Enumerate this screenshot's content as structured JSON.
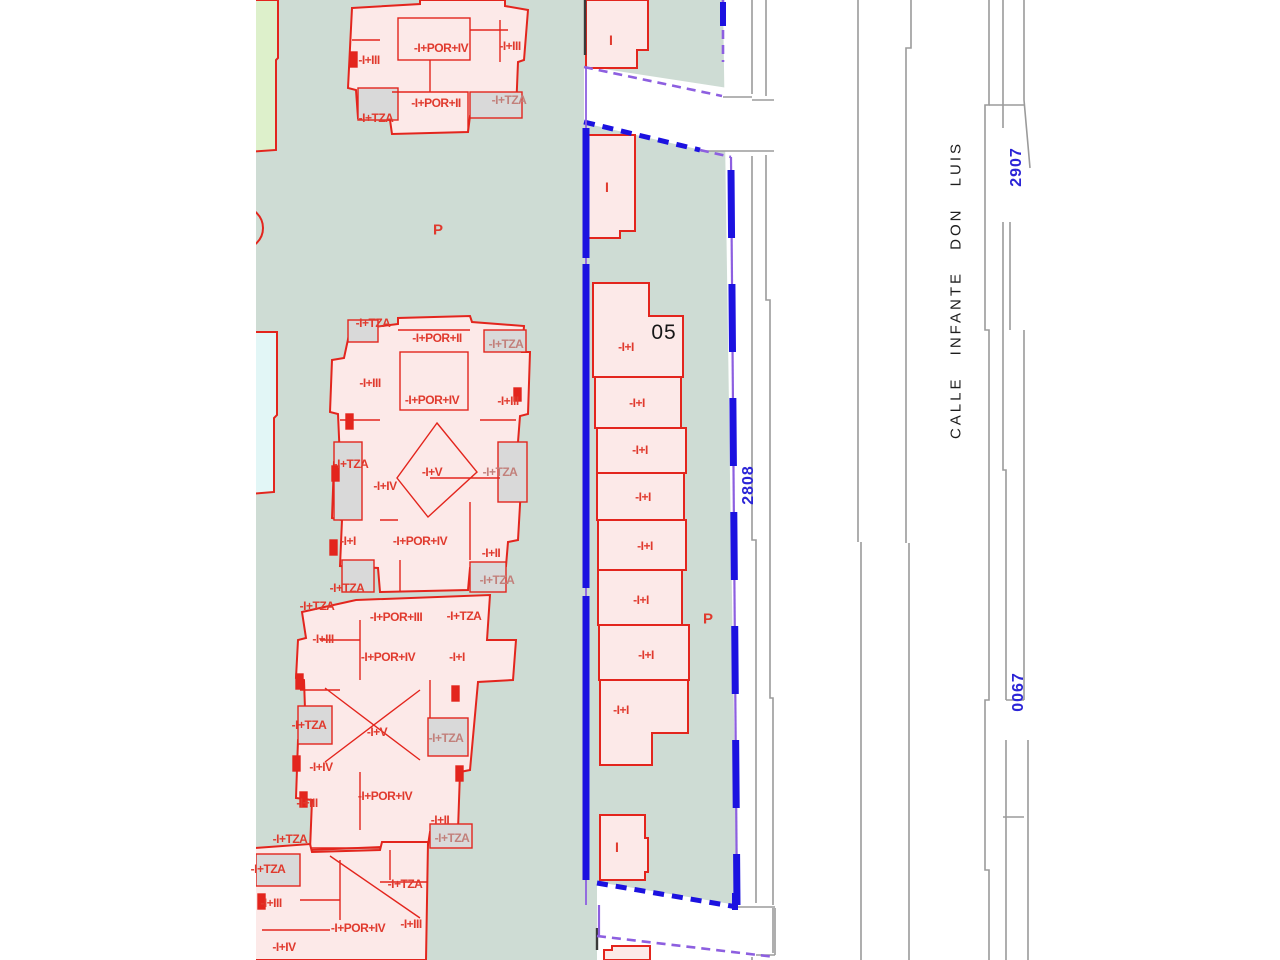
{
  "map": {
    "street_name": "CALLE INFANTE DON LUIS",
    "parcel_numbers": {
      "top": "2907",
      "middle": "2808",
      "bottom": "0067"
    },
    "block_number": "05",
    "colors": {
      "parcel_green": "#cedcd4",
      "building_pink": "#fce9e8",
      "building_outline_red": "#e3251d",
      "terrace_gray": "#d9d9d9",
      "boundary_blue": "#1c12e0",
      "boundary_purple": "#8d5fe0",
      "street_line_gray": "#9b9b9b",
      "parcel_number_blue": "#2b24d6",
      "side_parcel_green": "#ddf0cb",
      "side_parcel_cyan": "#e2f6f6"
    },
    "labels": [
      {
        "text": "-I+III",
        "x": 369,
        "y": 60
      },
      {
        "text": "-I+POR+IV",
        "x": 441,
        "y": 48
      },
      {
        "text": "-I+III",
        "x": 510,
        "y": 46
      },
      {
        "text": "-I+POR+II",
        "x": 436,
        "y": 103
      },
      {
        "text": "-I+TZA",
        "x": 509,
        "y": 100,
        "v": "muted"
      },
      {
        "text": "-I+TZA",
        "x": 376,
        "y": 118
      },
      {
        "text": "P",
        "x": 438,
        "y": 230,
        "v": "parking",
        "n": "parking-label"
      },
      {
        "text": "-I+TZA",
        "x": 373,
        "y": 323
      },
      {
        "text": "-I+POR+II",
        "x": 437,
        "y": 338
      },
      {
        "text": "-I+TZA",
        "x": 506,
        "y": 344,
        "v": "muted"
      },
      {
        "text": "-I+III",
        "x": 370,
        "y": 383
      },
      {
        "text": "-I+POR+IV",
        "x": 432,
        "y": 400
      },
      {
        "text": "-I+III",
        "x": 508,
        "y": 401
      },
      {
        "text": "-I+TZA",
        "x": 351,
        "y": 464
      },
      {
        "text": "-I+IV",
        "x": 385,
        "y": 486
      },
      {
        "text": "-I+V",
        "x": 432,
        "y": 472
      },
      {
        "text": "-I+TZA",
        "x": 500,
        "y": 472,
        "v": "muted"
      },
      {
        "text": "-I+I",
        "x": 348,
        "y": 541
      },
      {
        "text": "-I+POR+IV",
        "x": 420,
        "y": 541
      },
      {
        "text": "-I+II",
        "x": 491,
        "y": 553
      },
      {
        "text": "-I+TZA",
        "x": 497,
        "y": 580,
        "v": "muted"
      },
      {
        "text": "-I+TZA",
        "x": 347,
        "y": 588
      },
      {
        "text": "-I+TZA",
        "x": 317,
        "y": 606
      },
      {
        "text": "-I+POR+III",
        "x": 396,
        "y": 617
      },
      {
        "text": "-I+TZA",
        "x": 464,
        "y": 616
      },
      {
        "text": "-I+III",
        "x": 323,
        "y": 639
      },
      {
        "text": "-I+POR+IV",
        "x": 388,
        "y": 657
      },
      {
        "text": "-I+I",
        "x": 457,
        "y": 657
      },
      {
        "text": "-I+TZA",
        "x": 309,
        "y": 725
      },
      {
        "text": "-I+V",
        "x": 377,
        "y": 732
      },
      {
        "text": "-I+TZA",
        "x": 446,
        "y": 738,
        "v": "muted"
      },
      {
        "text": "-I+IV",
        "x": 321,
        "y": 767
      },
      {
        "text": "-I+POR+IV",
        "x": 385,
        "y": 796
      },
      {
        "text": "-I+III",
        "x": 307,
        "y": 803
      },
      {
        "text": "-I+II",
        "x": 440,
        "y": 820
      },
      {
        "text": "-I+TZA",
        "x": 452,
        "y": 838,
        "v": "muted"
      },
      {
        "text": "-I+TZA",
        "x": 290,
        "y": 839
      },
      {
        "text": "-I+TZA",
        "x": 268,
        "y": 869
      },
      {
        "text": "-I+TZA",
        "x": 405,
        "y": 884
      },
      {
        "text": "-I+III",
        "x": 271,
        "y": 903
      },
      {
        "text": "-I+POR+IV",
        "x": 358,
        "y": 928
      },
      {
        "text": "-I+III",
        "x": 411,
        "y": 924
      },
      {
        "text": "-I+IV",
        "x": 284,
        "y": 947
      },
      {
        "text": "P",
        "x": 708,
        "y": 619,
        "v": "parking",
        "n": "parking-label"
      },
      {
        "text": "-I+I",
        "x": 626,
        "y": 347,
        "n": "row-house-label"
      },
      {
        "text": "-I+I",
        "x": 637,
        "y": 403,
        "n": "row-house-label"
      },
      {
        "text": "-I+I",
        "x": 640,
        "y": 450,
        "n": "row-house-label"
      },
      {
        "text": "-I+I",
        "x": 643,
        "y": 497,
        "n": "row-house-label"
      },
      {
        "text": "-I+I",
        "x": 645,
        "y": 546,
        "n": "row-house-label"
      },
      {
        "text": "-I+I",
        "x": 641,
        "y": 600,
        "n": "row-house-label"
      },
      {
        "text": "-I+I",
        "x": 646,
        "y": 655,
        "n": "row-house-label"
      },
      {
        "text": "-I+I",
        "x": 621,
        "y": 710,
        "n": "row-house-label"
      },
      {
        "text": "I",
        "x": 611,
        "y": 40,
        "v": "roman",
        "n": "floors-label"
      },
      {
        "text": "I",
        "x": 607,
        "y": 187,
        "v": "roman",
        "n": "floors-label"
      },
      {
        "text": "I",
        "x": 617,
        "y": 847,
        "v": "roman",
        "n": "floors-label"
      }
    ]
  }
}
